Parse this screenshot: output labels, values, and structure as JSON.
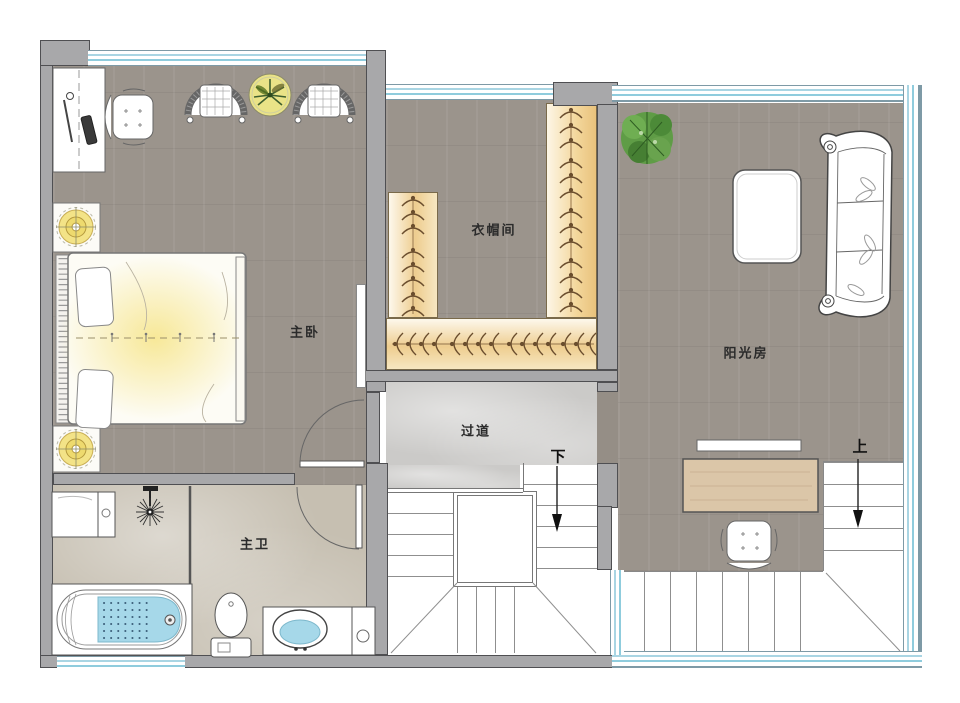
{
  "floorplan": {
    "rooms": {
      "master_bedroom": {
        "label": "主卧"
      },
      "cloakroom": {
        "label": "衣帽间"
      },
      "sunroom": {
        "label": "阳光房"
      },
      "corridor": {
        "label": "过道"
      },
      "master_bathroom": {
        "label": "主卫"
      }
    },
    "stairs": {
      "down_label": "下",
      "up_label": "上"
    },
    "colors": {
      "wall": "#a8a8aa",
      "wood_floor": "#9b948c",
      "corridor_marble": "#cbcac8",
      "bath_marble": "#c6bfb1",
      "wardrobe": "#eecd8f",
      "glass_line": "#a9d5e3",
      "lamp_glow": "#f3e387",
      "water": "#a6d8e9",
      "plant": "#5f9c46",
      "desk_wood": "#dbc6a8",
      "outline": "#555555"
    },
    "furniture": {
      "master_bedroom": [
        "desk",
        "desk-chair",
        "rattan-chair",
        "plant-table",
        "rattan-chair",
        "nightstand-lamp",
        "double-bed",
        "nightstand-lamp"
      ],
      "cloakroom": [
        "wardrobe-left",
        "wardrobe-right",
        "wardrobe-bottom"
      ],
      "sunroom": [
        "potted-plant",
        "coffee-table",
        "curved-sofa",
        "console-shelf",
        "wood-desk",
        "office-chair"
      ],
      "master_bathroom": [
        "laundry-unit",
        "ceiling-shower",
        "glass-partition",
        "bathtub",
        "toilet",
        "vanity-sink"
      ]
    }
  }
}
